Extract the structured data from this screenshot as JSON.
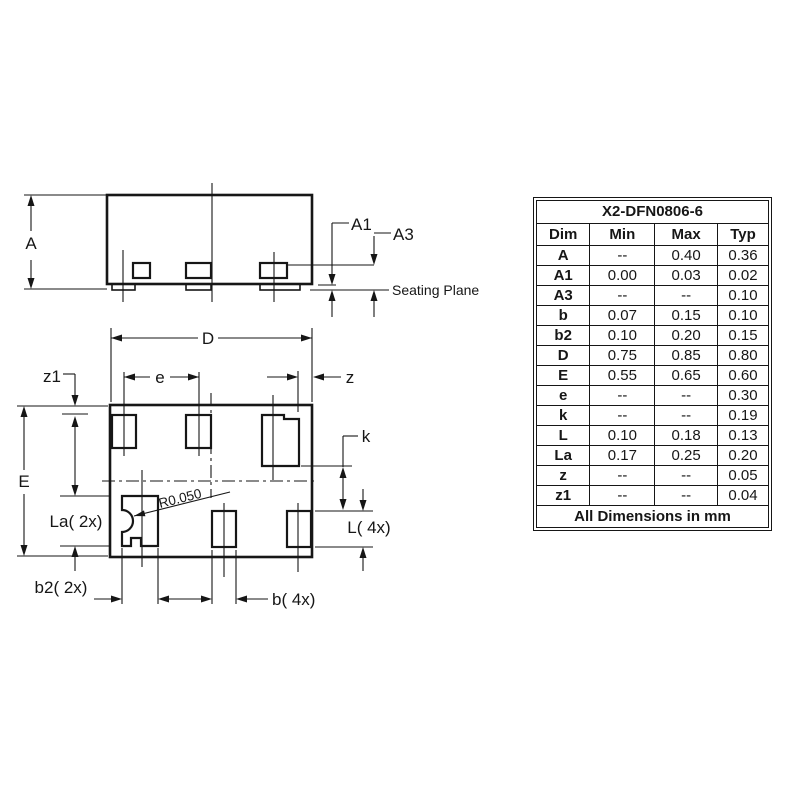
{
  "drawing": {
    "side": {
      "a": "A",
      "a1": "A1",
      "a3": "A3",
      "seating_plane": "Seating Plane"
    },
    "bottom": {
      "d": "D",
      "e": "e",
      "z": "z",
      "z1": "z1",
      "big_e": "E",
      "k": "k",
      "la": "La( 2x)",
      "l": "L( 4x)",
      "b2": "b2( 2x)",
      "b": "b( 4x)",
      "radius": "R0.050"
    }
  },
  "table": {
    "title": "X2-DFN0806-6",
    "headers": [
      "Dim",
      "Min",
      "Max",
      "Typ"
    ],
    "rows": [
      {
        "dim": "A",
        "min": "--",
        "max": "0.40",
        "typ": "0.36"
      },
      {
        "dim": "A1",
        "min": "0.00",
        "max": "0.03",
        "typ": "0.02"
      },
      {
        "dim": "A3",
        "min": "--",
        "max": "--",
        "typ": "0.10"
      },
      {
        "dim": "b",
        "min": "0.07",
        "max": "0.15",
        "typ": "0.10"
      },
      {
        "dim": "b2",
        "min": "0.10",
        "max": "0.20",
        "typ": "0.15"
      },
      {
        "dim": "D",
        "min": "0.75",
        "max": "0.85",
        "typ": "0.80"
      },
      {
        "dim": "E",
        "min": "0.55",
        "max": "0.65",
        "typ": "0.60"
      },
      {
        "dim": "e",
        "min": "--",
        "max": "--",
        "typ": "0.30"
      },
      {
        "dim": "k",
        "min": "--",
        "max": "--",
        "typ": "0.19"
      },
      {
        "dim": "L",
        "min": "0.10",
        "max": "0.18",
        "typ": "0.13"
      },
      {
        "dim": "La",
        "min": "0.17",
        "max": "0.25",
        "typ": "0.20"
      },
      {
        "dim": "z",
        "min": "--",
        "max": "--",
        "typ": "0.05"
      },
      {
        "dim": "z1",
        "min": "--",
        "max": "--",
        "typ": "0.04"
      }
    ],
    "footer": "All Dimensions in mm"
  },
  "colors": {
    "line": "#161616",
    "background": "#ffffff"
  }
}
